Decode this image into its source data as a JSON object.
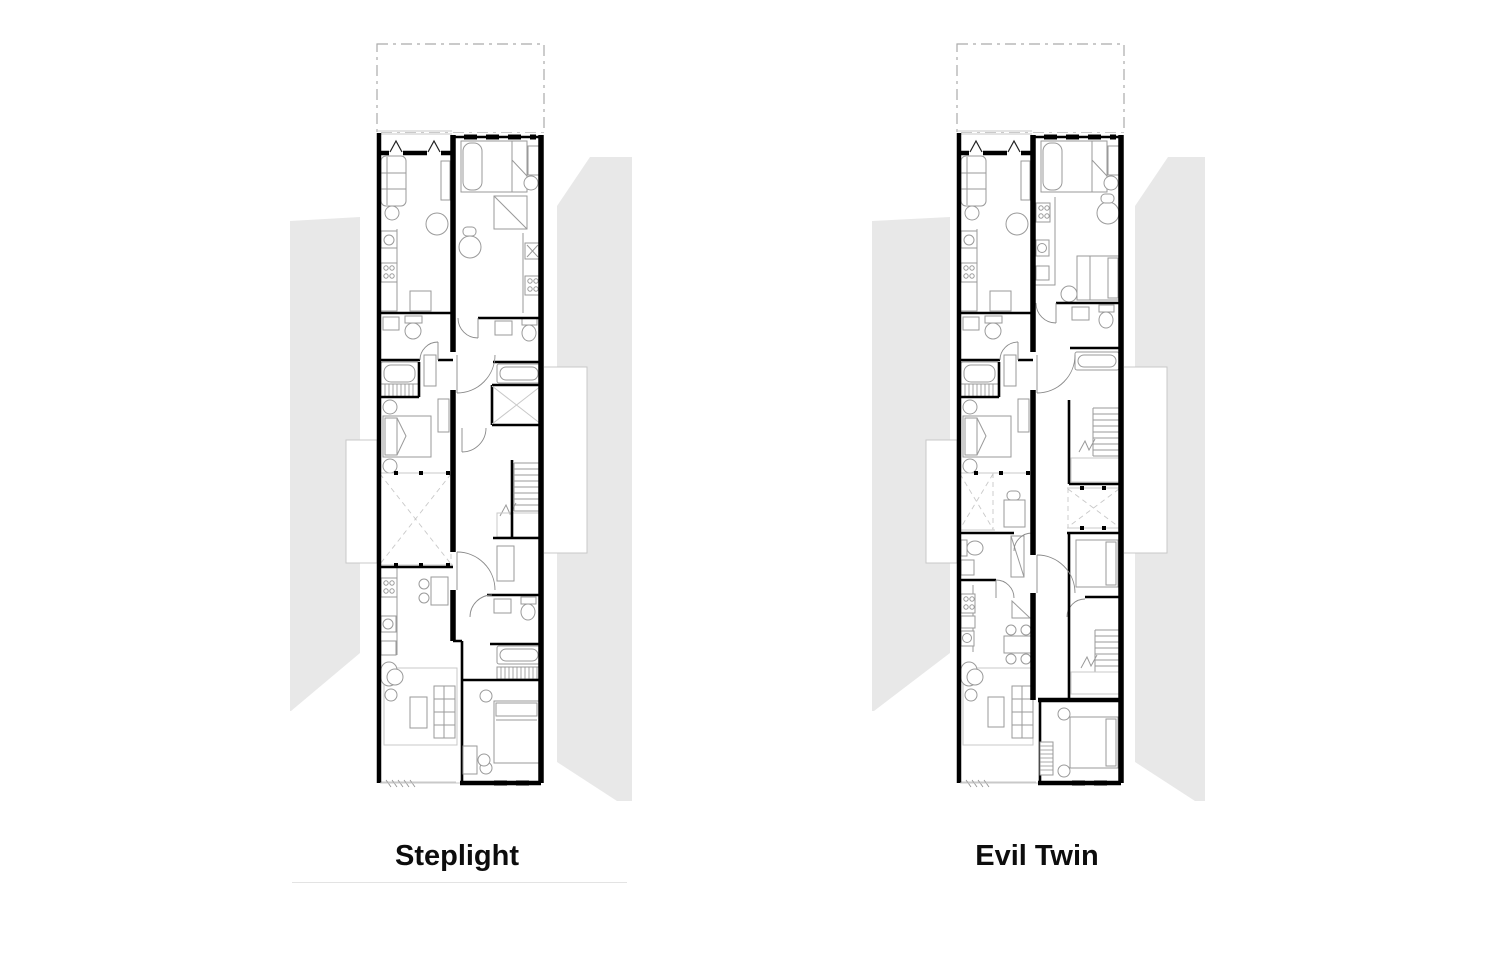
{
  "figure": {
    "type": "architectural-floor-plan-comparison",
    "plans": [
      {
        "id": "steplight",
        "title": "Steplight",
        "has_caption_rule": true
      },
      {
        "id": "evil-twin",
        "title": "Evil Twin",
        "has_caption_rule": false
      }
    ]
  },
  "colors": {
    "bg": "#ffffff",
    "wall": "#000000",
    "furn": "#9a9a9a",
    "mass": "#e8e8e8",
    "lite": "#c9c9c9",
    "dash": "#ababab",
    "caption_text": "#0d0d0d",
    "caption_rule": "#e3e3e3"
  }
}
